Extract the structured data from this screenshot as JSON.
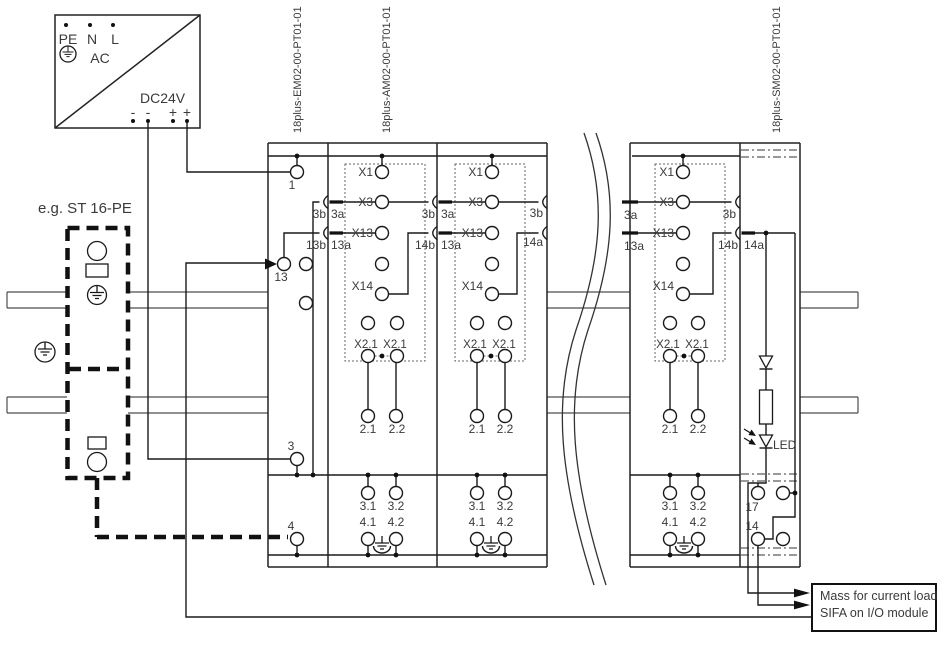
{
  "power_supply": {
    "pin_pe": "PE",
    "pin_n": "N",
    "pin_l": "L",
    "ac_label": "AC",
    "dc_label": "DC24V",
    "minus": "-",
    "plus": "+"
  },
  "din_rail": {
    "example_label": "e.g. ST 16-PE"
  },
  "module_labels": {
    "em": "18plus-EM02-00-PT01-01",
    "am": "18plus-AM02-00-PT01-01",
    "sm": "18plus-SM02-00-PT01-01"
  },
  "terminals": {
    "t1": "1",
    "t13": "13",
    "t3": "3",
    "t4": "4",
    "t17": "17",
    "t14": "14"
  },
  "contact_labels": {
    "x1": "X1",
    "x3": "X3",
    "x13": "X13",
    "x14": "X14",
    "x21": "X2.1"
  },
  "pin_labels": {
    "p21": "2.1",
    "p22": "2.2",
    "p31": "3.1",
    "p32": "3.2",
    "p41": "4.1",
    "p42": "4.2"
  },
  "connector_labels": {
    "c3a": "3a",
    "c3b": "3b",
    "c13a": "13a",
    "c13b": "13b",
    "c14a": "14a",
    "c14b": "14b"
  },
  "led_label": "LED",
  "output_box": {
    "line1": "Mass for current load",
    "line2": "SIFA on I/O module"
  },
  "colors": {
    "wire": "#1a1a1a",
    "rail": "#4d4d4d",
    "text": "#3a3a3a",
    "background": "#ffffff"
  }
}
